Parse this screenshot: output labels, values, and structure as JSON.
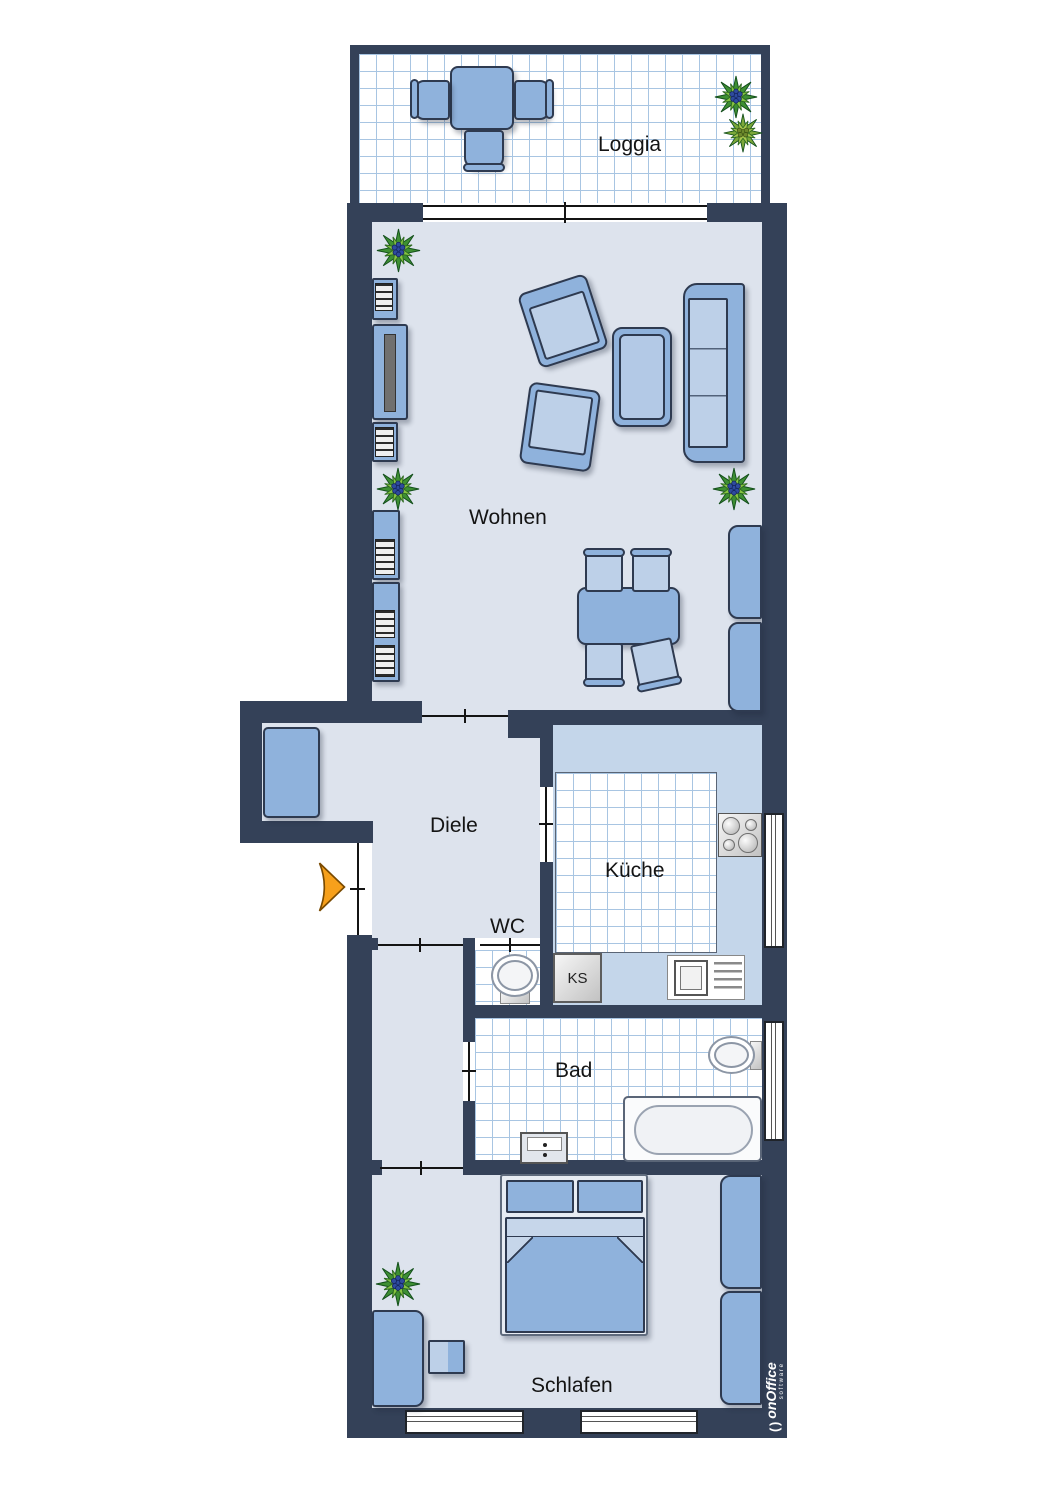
{
  "rooms": [
    {
      "id": "loggia",
      "name": "Loggia"
    },
    {
      "id": "wohnen",
      "name": "Wohnen"
    },
    {
      "id": "diele",
      "name": "Diele"
    },
    {
      "id": "kueche",
      "name": "Küche"
    },
    {
      "id": "wc",
      "name": "WC"
    },
    {
      "id": "bad",
      "name": "Bad"
    },
    {
      "id": "schlafen",
      "name": "Schlafen"
    }
  ],
  "kitchen": {
    "fridge_label": "KS"
  },
  "branding": {
    "logo_mark": "( )",
    "name": "onOffice",
    "tagline": "software"
  },
  "colors": {
    "wall": "#344158",
    "room_floor": "#dde3ed",
    "kitchen_counter": "#c4d6ea",
    "tile_line": "#a8c5e2",
    "furniture_blue": "#8fb2dc",
    "furniture_blue_light": "#bdd0e8",
    "furniture_outline": "#2e3a50",
    "entrance_arrow": "#f7a01b",
    "plant_dark_green": "#3e8f33",
    "plant_light_green": "#86c440",
    "plant_berries": "#2e4b9e",
    "logo_text": "#ffffff"
  },
  "symbols": [
    "dining-table",
    "chair",
    "armchair",
    "sofa",
    "coffee-table",
    "tv-sideboard",
    "shelf",
    "wardrobe",
    "bed",
    "desk",
    "stove",
    "kitchen-sink",
    "fridge",
    "toilet",
    "bathtub",
    "washbasin",
    "plant",
    "entrance-arrow",
    "window",
    "door-opening"
  ]
}
